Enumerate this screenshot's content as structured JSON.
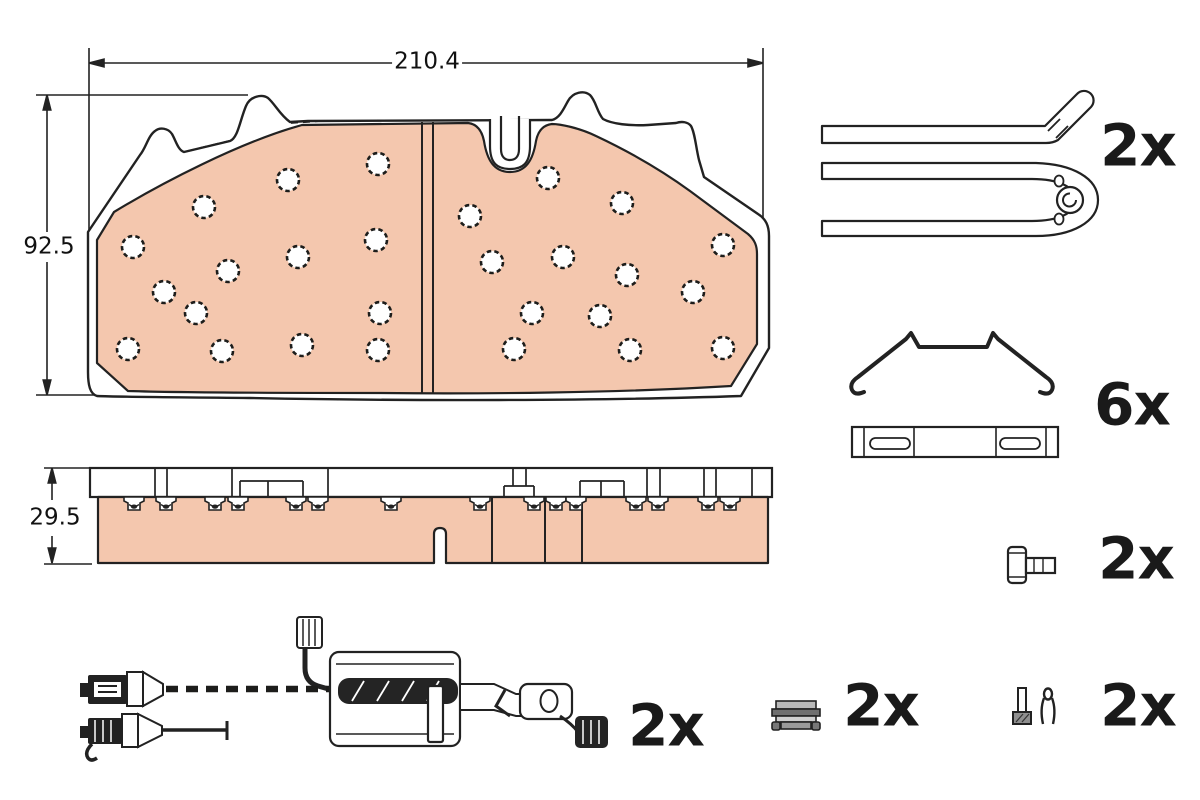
{
  "front_view": {
    "width_label": "210.4",
    "height_label": "92.5"
  },
  "side_view": {
    "thickness_label": "29.5"
  },
  "quantities": {
    "retainer_pins": "2x",
    "spring_clips": "6x",
    "guide_bolts": "2x",
    "wear_sensors": "2x",
    "retaining_clips": "2x",
    "fixing_pins": "2x"
  },
  "colors": {
    "friction_material": "#f4c7ae",
    "line_art": "#222222",
    "background": "#ffffff"
  }
}
